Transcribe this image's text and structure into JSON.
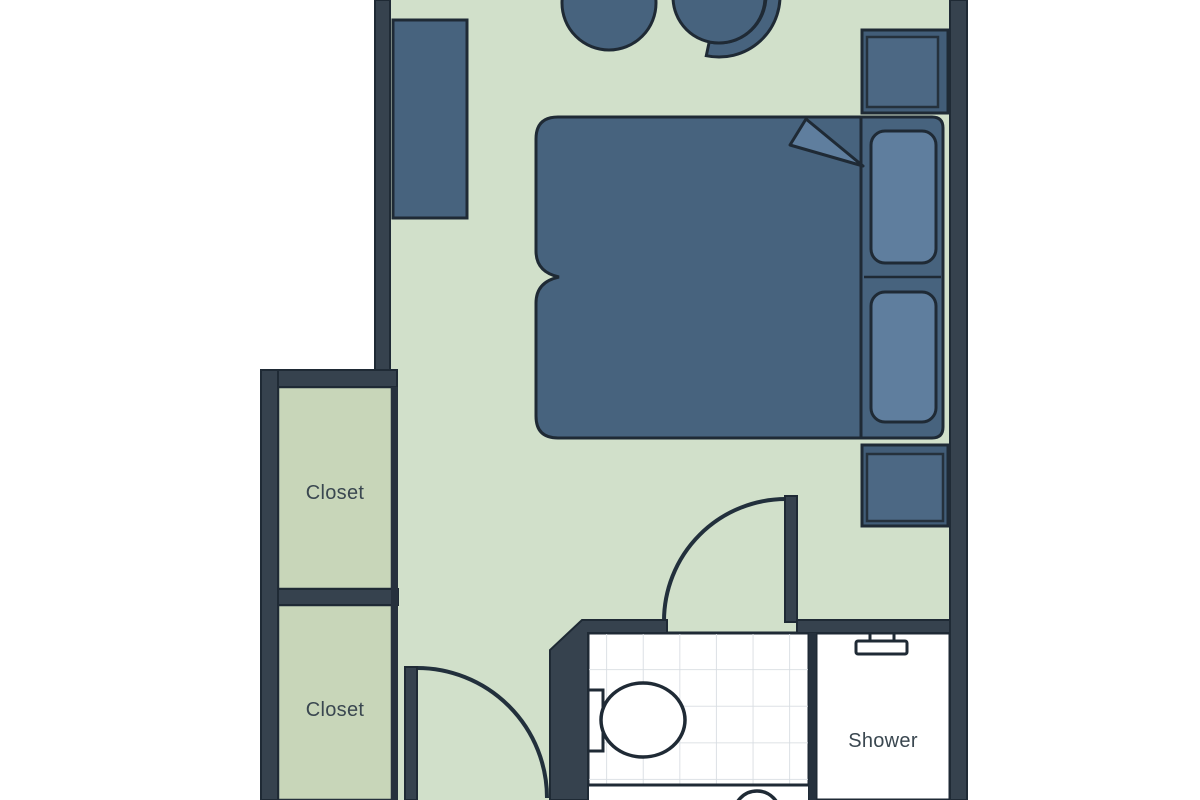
{
  "floor_plan": {
    "type": "studio-room-floor-plan",
    "labels": {
      "closet_upper": "Closet",
      "closet_lower": "Closet",
      "shower": "Shower"
    },
    "furniture": [
      "dresser",
      "stool",
      "chair",
      "double-bed",
      "duvet-fold",
      "pillow",
      "pillow",
      "nightstand",
      "nightstand",
      "entrance-door",
      "bathroom-door",
      "toilet",
      "sink-basin",
      "shower-head"
    ],
    "colors": {
      "background": "#ffffff",
      "wall": "#36424e",
      "outline": "#1f2a35",
      "bedroom_floor": "#d1e0ca",
      "closet_floor": "#c8d6b9",
      "furniture_fill": "#47637e",
      "furniture_light": "#5f7e9e",
      "bathroom_floor": "#ffffff",
      "tile_line": "#d8dde2",
      "label_text": "#3a4750"
    }
  }
}
